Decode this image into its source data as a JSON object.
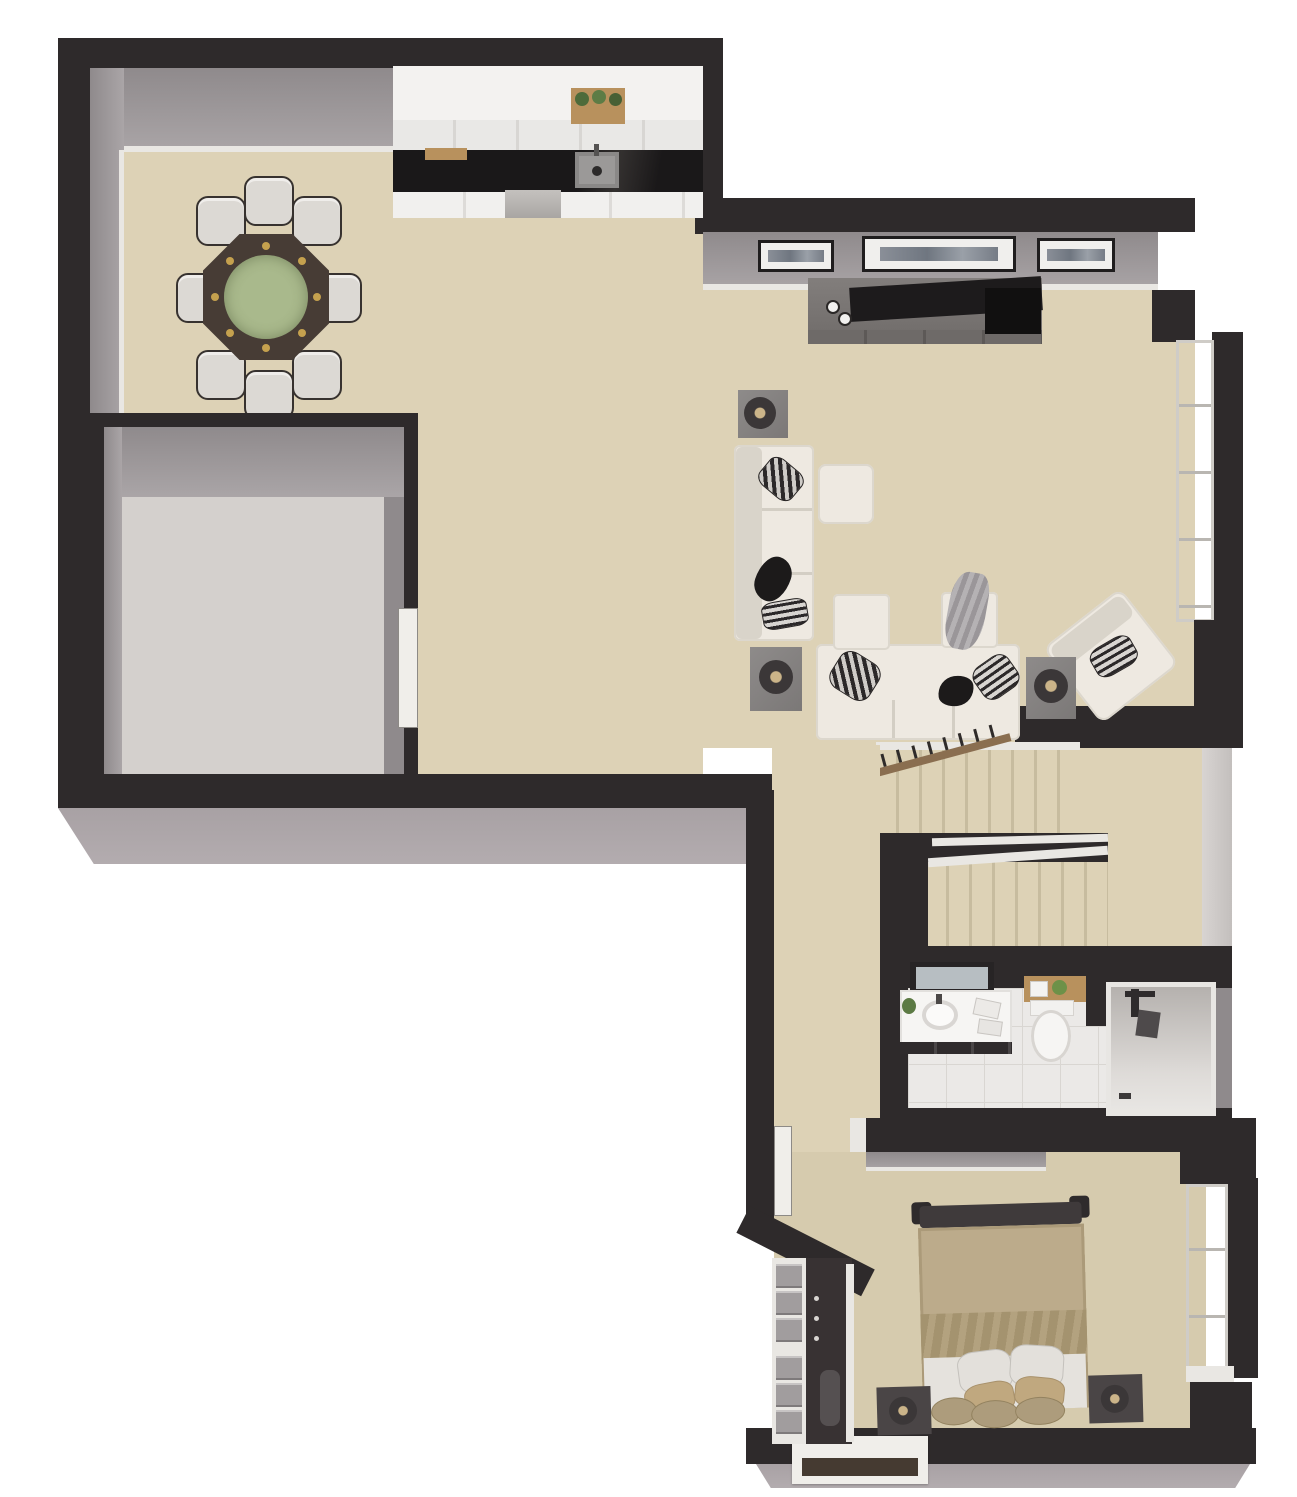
{
  "scene": {
    "type": "3d-floor-plan-render",
    "view": "top-down dollhouse",
    "background": "#ffffff",
    "title": "Main level 3D floor plan"
  },
  "palette": {
    "floor": "#ddd2b6",
    "floorBedroom": "#d6cbae",
    "wall": "#2e2a2b",
    "wallDark": "#242122",
    "wallFace": "#8f8a8c",
    "wallFaceLight": "#aaa5a7",
    "trim": "#e9e7e3",
    "concrete": "#a8a1a4",
    "garageFloor": "#d4d0cd",
    "cabinet": "#f3f2f0",
    "counter": "#1a1819",
    "wood": "#b8915d",
    "tile": "#ebe9e7",
    "tileLine": "#d9d6d2",
    "showerTile": "#b5b1ae",
    "sofa": "#eee9e1",
    "sofaShadow": "#d9d4ca",
    "tableGray": "#8e8b8a",
    "console": "#827e7c",
    "tv": "#1d1b1c",
    "diningWood": "#473c35",
    "felt": "#a9b98c",
    "gold": "#c5a14e",
    "chair": "#dcd9d4",
    "bed": "#bcab8b",
    "bedWrinkle": "#a4936f",
    "pillow": "#e3e0db",
    "pillowTan": "#c0a87f",
    "nightstand": "#4a4546",
    "railWood": "#8a6e50",
    "door": "#f0eeea",
    "black": "#1c1a1a",
    "lampGold": "#cbb489",
    "glassGray": "#b7bec2"
  },
  "rooms": [
    {
      "id": 0,
      "name": "Dining room",
      "furniture": [
        "octagonal game/dining table with green felt top and cup holders",
        "8 upholstered chairs"
      ]
    },
    {
      "id": 1,
      "name": "Kitchen",
      "furniture": [
        "upper cabinets",
        "black countertop",
        "double sink",
        "range",
        "floating wood shelf with 3 plants",
        "cutting board"
      ]
    },
    {
      "id": 2,
      "name": "Garage / unfinished room",
      "furniture": [
        "entry door"
      ]
    },
    {
      "id": 3,
      "name": "Living room",
      "furniture": [
        "media console with TV",
        "3 framed wall art",
        "3-seat sofa",
        "chaise sofa",
        "ottoman",
        "armchair",
        "3 side tables with lamps",
        "bay window"
      ]
    },
    {
      "id": 4,
      "name": "Staircase",
      "furniture": [
        "upper flight",
        "lower flight",
        "carpeted landing",
        "wood handrail with balusters",
        "white stringers"
      ]
    },
    {
      "id": 5,
      "name": "Hallway",
      "furniture": []
    },
    {
      "id": 6,
      "name": "Bathroom",
      "furniture": [
        "vanity with sink and mirror",
        "toilet",
        "wall shelf with towels and plant",
        "walk-in shower with fixture"
      ]
    },
    {
      "id": 7,
      "name": "Bedroom",
      "furniture": [
        "bed with tan duvet and pillows",
        "headboard",
        "2 nightstands with lamps",
        "bay window",
        "box window",
        "entry door"
      ]
    },
    {
      "id": 8,
      "name": "Closet",
      "furniture": [
        "drawer tower",
        "hanging rod with clothes",
        "sliding door"
      ]
    }
  ]
}
